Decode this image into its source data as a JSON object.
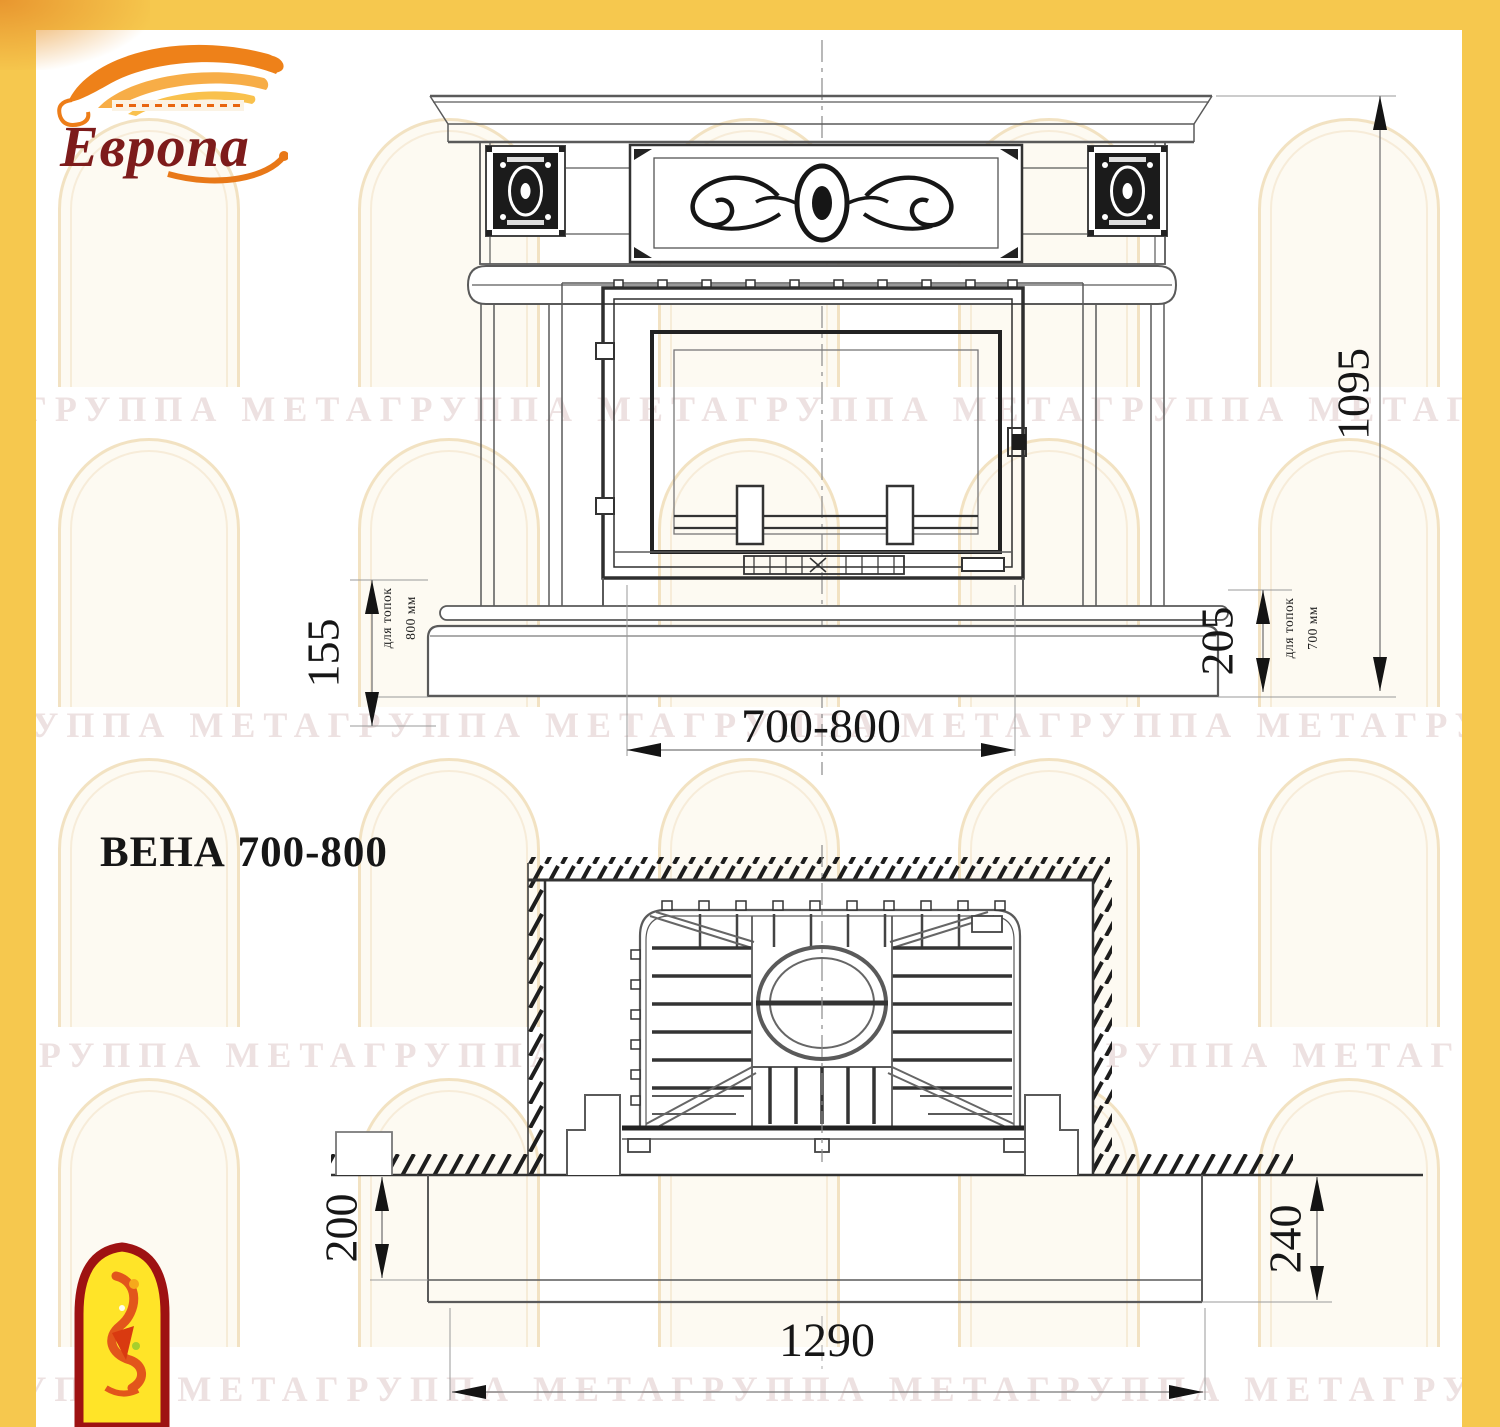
{
  "brand": {
    "logo_text": "Европа"
  },
  "title": {
    "model": "ВЕНА 700-800"
  },
  "front_view": {
    "dims": {
      "overall_height": "1095",
      "firebox_width_range": "700-800",
      "left_plinth_height": "155",
      "left_note_line1": "для топок",
      "left_note_line2": "800 мм",
      "right_plinth_height": "205",
      "right_note_line1": "для топок",
      "right_note_line2": "700 мм"
    }
  },
  "plan_view": {
    "dims": {
      "hearth_height_left": "200",
      "hearth_height_right": "240",
      "hearth_width": "1290"
    }
  },
  "watermark": {
    "text": "ГРУППА МЕТАГРУППА МЕТАГРУППА МЕТАГРУППА МЕТАГРУППА МЕТА"
  },
  "colors": {
    "border_yellow": "#F6C84E",
    "brand_red": "#7D1B1B",
    "flame_orange": "#ED7D18",
    "drawing_line": "#5A5A5A",
    "ornament_black": "#1B1B1B",
    "watermark_text": "#EDE1E1"
  }
}
